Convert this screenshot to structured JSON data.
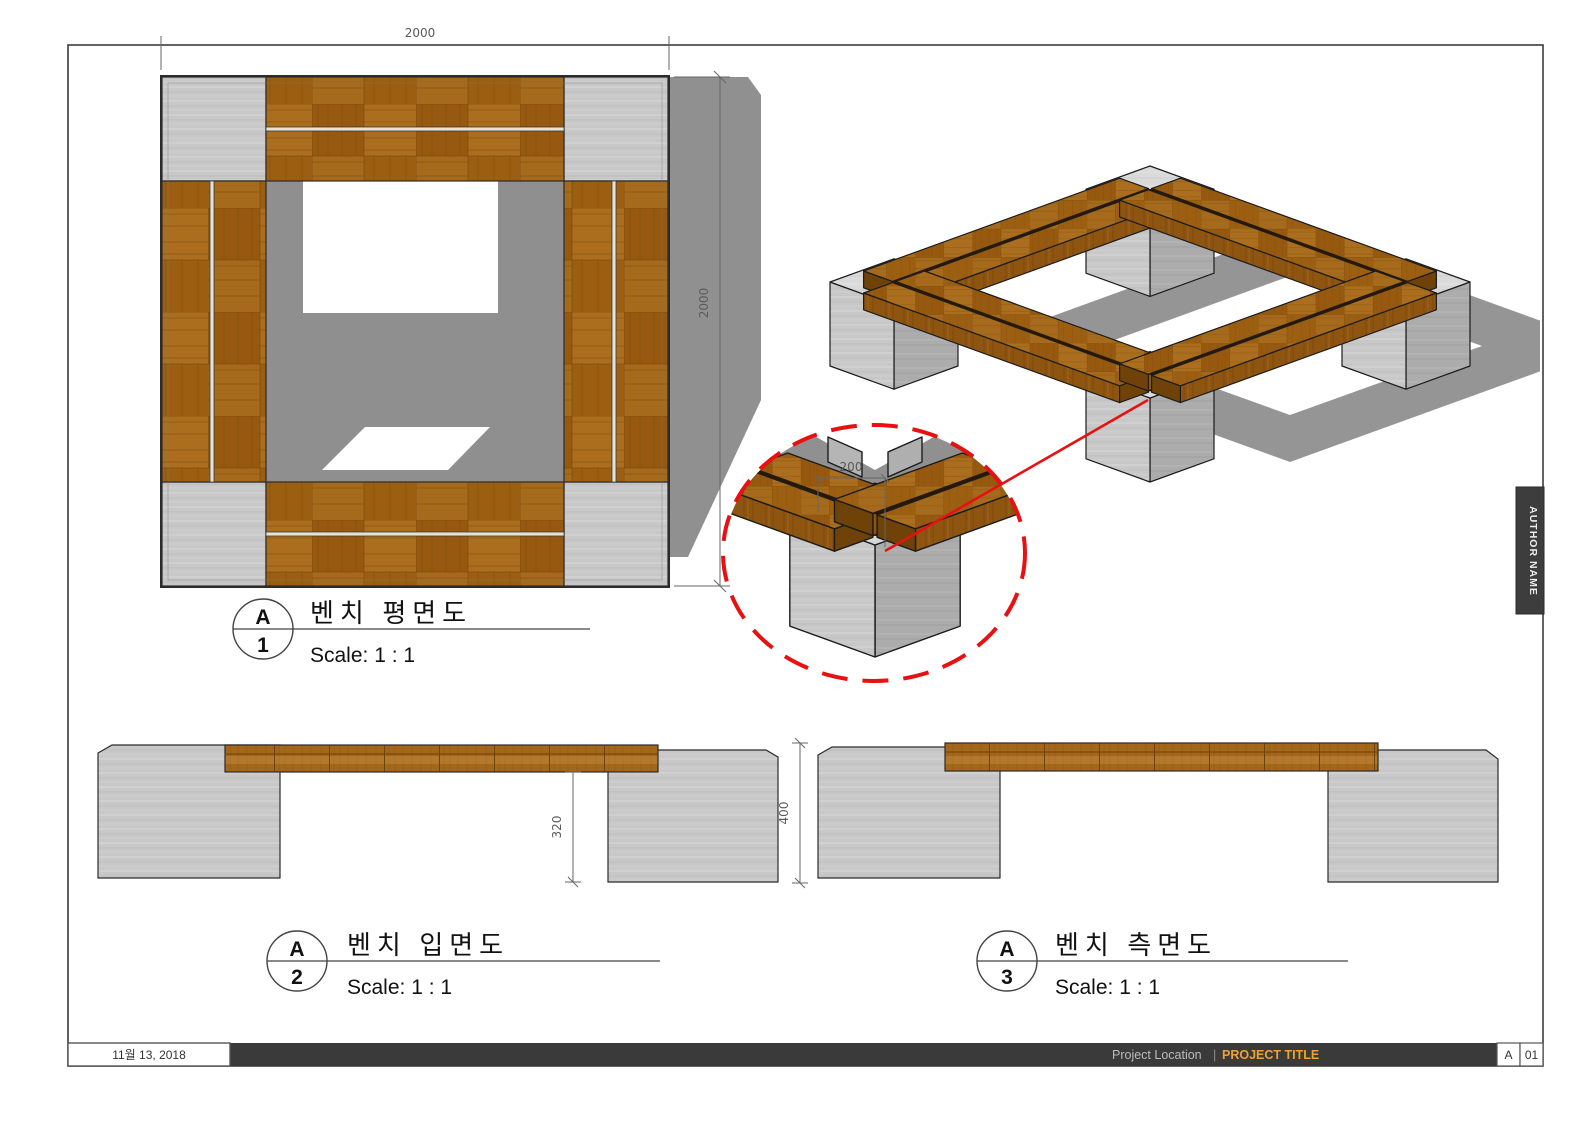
{
  "sheet": {
    "author_tab": {
      "label": "AUTHOR NAME"
    },
    "title_bar": {
      "date": "11월 13, 2018",
      "project_location": "Project Location",
      "divider": "|",
      "project_title": "PROJECT TITLE",
      "revision": "A",
      "sheet_number": "01",
      "accent_color": "#F0A030",
      "bar_color": "#3A3A3A"
    }
  },
  "dims": {
    "plan_width": "2000",
    "plan_depth": "2000",
    "detail_offset": "200",
    "elev_clearance": "320",
    "side_height": "400"
  },
  "labels": {
    "plan": {
      "letter": "A",
      "number": "1",
      "title": "벤치 평면도",
      "scale": "Scale:  1 : 1"
    },
    "elevation": {
      "letter": "A",
      "number": "2",
      "title": "벤치 입면도",
      "scale": "Scale:  1 : 1"
    },
    "side": {
      "letter": "A",
      "number": "3",
      "title": "벤치 측면도",
      "scale": "Scale:  1 : 1"
    }
  },
  "colors": {
    "wood": "#A2671A",
    "wood_dark": "#6E4209",
    "concrete": "#C8C8C8",
    "shadow": "#909090",
    "detail_red": "#E81010",
    "line": "#1c1c1c"
  }
}
